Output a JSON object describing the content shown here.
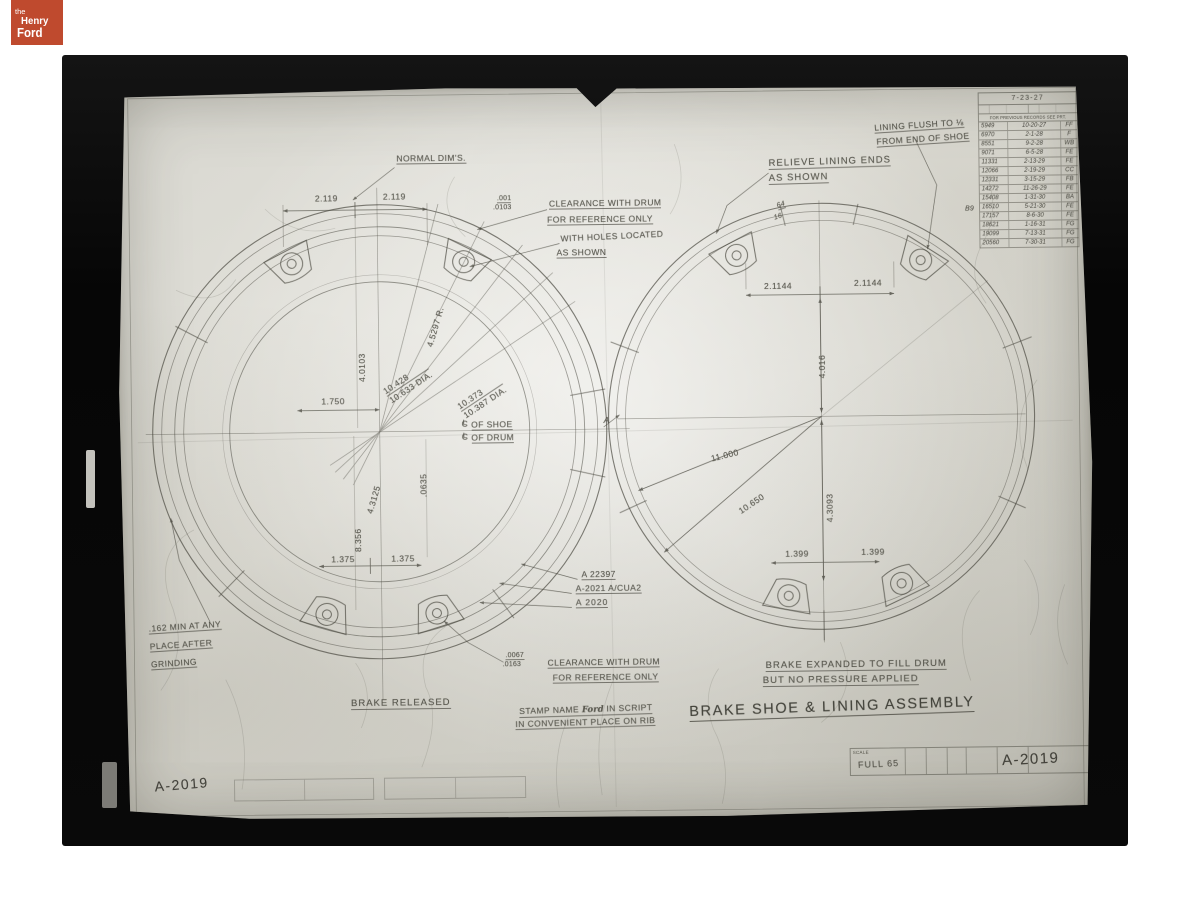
{
  "logo": {
    "line1": "the",
    "line2": "Henry",
    "line3": "Ford"
  },
  "title": "BRAKE SHOE & LINING ASSEMBLY",
  "corner_number": "A-2019",
  "title_block": {
    "scale_label": "SCALE",
    "scale_value": "FULL 65",
    "number": "A-2019"
  },
  "sym": {
    "c": "C",
    "l": "L"
  },
  "notes": {
    "normal_dims": "NORMAL DIM'S.",
    "clr_top_a": ".001",
    "clr_top_b": ".0103",
    "clr_top_1": "CLEARANCE WITH DRUM",
    "clr_top_2": "FOR REFERENCE ONLY",
    "holes_1": "WITH HOLES LOCATED",
    "holes_2": "AS SHOWN",
    "relieve_1": "RELIEVE LINING ENDS",
    "relieve_2": "AS SHOWN",
    "flush_1": "LINING FLUSH TO ⅛",
    "flush_2": "FROM END OF SHOE",
    "grind_1": ".162 MIN AT ANY",
    "grind_2": "PLACE AFTER",
    "grind_3": "GRINDING",
    "clr_bot_a": ".0067",
    "clr_bot_b": ".0163",
    "clr_bot_1": "CLEARANCE WITH DRUM",
    "clr_bot_2": "FOR REFERENCE ONLY",
    "stamp_pre": "STAMP NAME",
    "stamp_script": "Ford",
    "stamp_post": "IN SCRIPT",
    "stamp_2": "IN CONVENIENT PLACE ON RIB",
    "released": "BRAKE RELEASED",
    "expanded_1": "BRAKE EXPANDED TO FILL DRUM",
    "expanded_2": "BUT NO PRESSURE APPLIED",
    "section_label": "A"
  },
  "dims_left": {
    "d2119a": "2.119",
    "d2119b": "2.119",
    "r45297": "4.5297 R.",
    "d40103": "4.0103",
    "dia_a1": "10.428",
    "dia_a2": "10.633 DIA.",
    "dia_b1": "10.373",
    "dia_b2": "10.387 DIA.",
    "d1750": "1.750",
    "cl_shoe": "OF SHOE",
    "cl_drum": "OF DRUM",
    "d43125": "4.3125",
    "d0635": ".0635",
    "d8356": "8.356",
    "d1375a": "1.375",
    "d1375b": "1.375"
  },
  "dims_right": {
    "d21144a": "2.1144",
    "d21144b": "2.1144",
    "d4016": "4.016",
    "d11000": "11.000",
    "d10650": "10.650",
    "d43093": "4.3093",
    "d1399a": "1.399",
    "d1399b": "1.399",
    "frac_a": "64",
    "frac_b": "16"
  },
  "parts": {
    "p1": "A 22397",
    "p2": "A-2021 A/CUA2",
    "p3": "A 2020"
  },
  "revision_table": {
    "date": "7-23-27",
    "subheader": "FOR PREVIOUS RECORDS SEE PRT.",
    "side_note": "B9",
    "rows": [
      [
        "5949",
        "10-20-27",
        "FF"
      ],
      [
        "6970",
        "2-1-28",
        "F"
      ],
      [
        "8551",
        "9-2-28",
        "WB"
      ],
      [
        "9071",
        "6-5-28",
        "FE"
      ],
      [
        "11331",
        "2-13-29",
        "FE"
      ],
      [
        "12066",
        "2-19-29",
        "CC"
      ],
      [
        "12331",
        "3-15-29",
        "FB"
      ],
      [
        "14272",
        "11-26-29",
        "FE"
      ],
      [
        "15408",
        "1-31-30",
        "BA"
      ],
      [
        "16510",
        "5-21-30",
        "FE"
      ],
      [
        "17157",
        "8-6-30",
        "FE"
      ],
      [
        "18621",
        "1-16-31",
        "FG"
      ],
      [
        "19099",
        "7-13-31",
        "FG"
      ],
      [
        "20560",
        "7-30-31",
        "FG"
      ]
    ]
  }
}
